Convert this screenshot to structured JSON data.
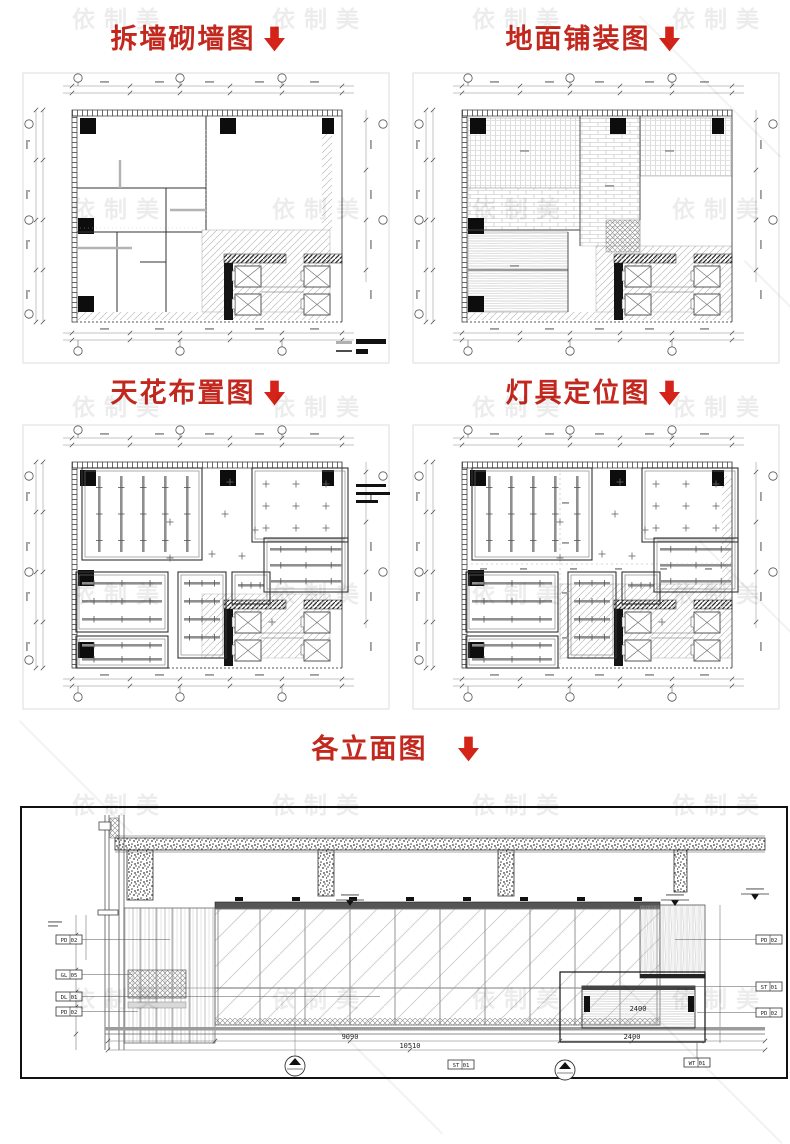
{
  "titles": {
    "demolition": "拆墙砌墙图",
    "paving": "地面铺装图",
    "ceiling": "天花布置图",
    "lighting": "灯具定位图",
    "elevation": "各立面图"
  },
  "watermark": {
    "text": "依制美"
  },
  "elevation": {
    "tags_left": [
      "PD 02",
      "GL 05",
      "DL 01",
      "PD 02"
    ],
    "tags_right": [
      "PD 02",
      "ST 01",
      "PD 02"
    ],
    "tags_bottom": [
      "ST 01",
      "WT 01"
    ],
    "dims": {
      "counter_width": "2400",
      "counter_total": "2400",
      "span": "9090",
      "overall": "10510"
    }
  },
  "colors": {
    "title": "#c2281e",
    "arrow": "#d42318"
  }
}
